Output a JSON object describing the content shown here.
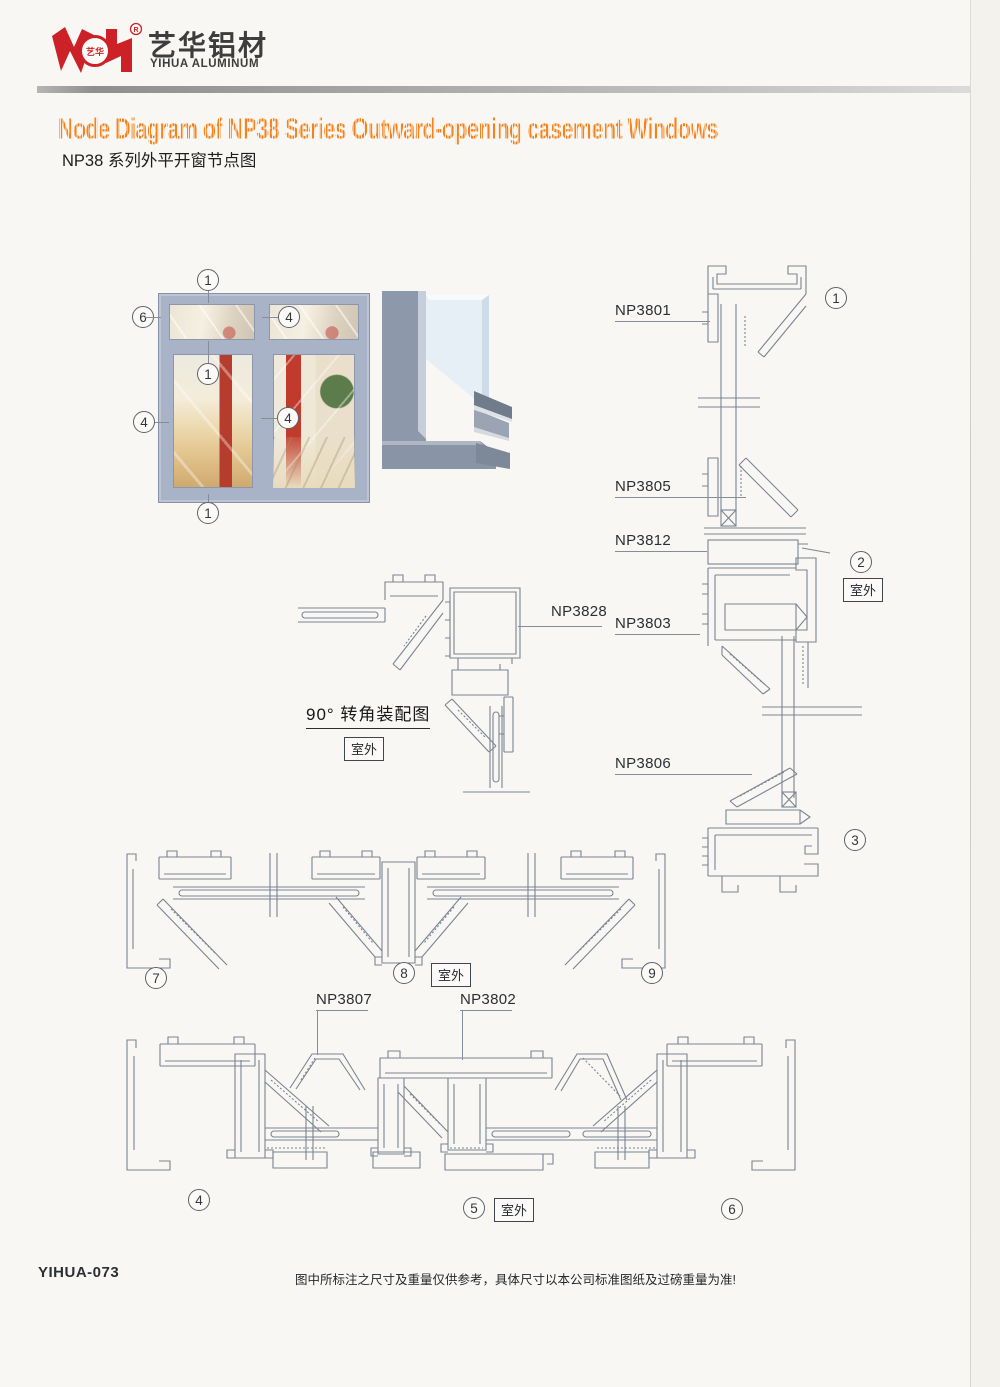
{
  "brand": {
    "name_cn": "艺华铝材",
    "name_en": "YIHUA ALUMINUM",
    "reg": "R",
    "seal": "艺华"
  },
  "page": {
    "title_en": "Node Diagram of NP38 Series Outward-opening casement Windows",
    "title_cn": "NP38 系列外平开窗节点图",
    "footer_code": "YIHUA-073",
    "footer_note": "图中所标注之尺寸及重量仅供参考，具体尺寸以本公司标准图纸及过磅重量为准!"
  },
  "annotations": {
    "outdoor": "室外",
    "corner_caption": "90°  转角装配图"
  },
  "profiles": {
    "np3801": "NP3801",
    "np3805": "NP3805",
    "np3812": "NP3812",
    "np3803": "NP3803",
    "np3806": "NP3806",
    "np3828": "NP3828",
    "np3807": "NP3807",
    "np3802": "NP3802"
  },
  "window_callouts": [
    "1",
    "6",
    "4",
    "1",
    "4",
    "4",
    "1"
  ],
  "detail_numbers": [
    "1",
    "2",
    "3",
    "4",
    "5",
    "6",
    "7",
    "8",
    "9"
  ],
  "colors": {
    "accent_orange": "#F5821F",
    "brand_red": "#CC2127",
    "drawing_line": "#7B8492",
    "window_frame": "#A9B3C7"
  }
}
